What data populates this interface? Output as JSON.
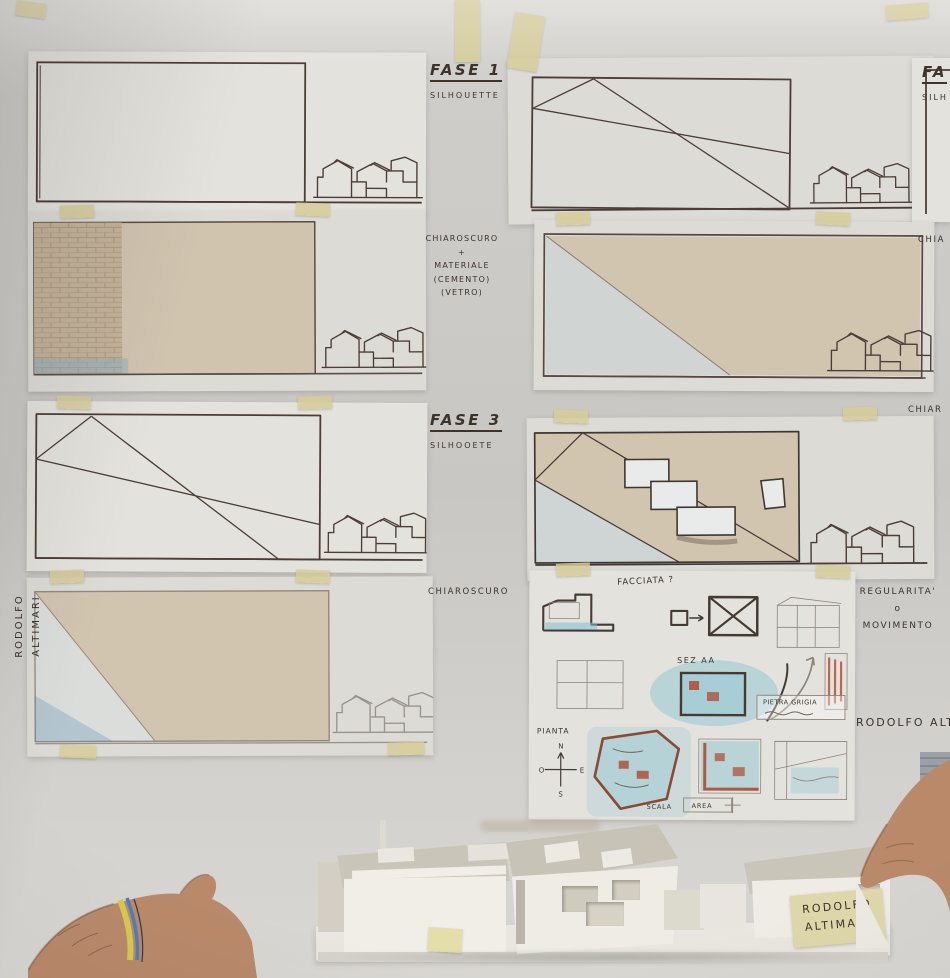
{
  "scene": {
    "description": "Architecture studio pin-up wall: phased facade studies on tracing paper taped above a white cardboard massing model held by two people"
  },
  "colors": {
    "tape": "#d5cc96",
    "wall": "#cbc9c5",
    "paper": "#e4e2dd",
    "render_beige": "#d1c5b0",
    "pencil_cyan": "#7ec0cf",
    "pencil_red": "#b04a30",
    "ink": "#4a3e37",
    "skin": "#b9896a",
    "model_white": "#efede6"
  },
  "labels": {
    "fase1": {
      "title": "FASE 1",
      "subtitle": "SILHOUETTE"
    },
    "fase2_cut": {
      "title": "FA",
      "subtitle": "SILH"
    },
    "materiale": {
      "line1": "CHIAROSCURO",
      "line2": "+",
      "line3": "MATERIALE",
      "line4": "(CEMENTO)",
      "line5": "(VETRO)"
    },
    "chia_cut": "CHIA",
    "fase3": {
      "title": "FASE 3",
      "subtitle": "SILHOOETE"
    },
    "chiar_cut": "CHIAR",
    "chiaroscuro": "CHIAROSCURO",
    "regularita": {
      "line1": "REGULARITA'",
      "line2": "o",
      "line3": "MOVIMENTO"
    },
    "author_vertical": {
      "line1": "RODOLFO",
      "line2": "ALTIMARI"
    },
    "author_right_cut": "RODOLFO ALTI",
    "model_tag": {
      "line1": "RODOLFO",
      "line2": "ALTIMARI"
    }
  },
  "sketch_sheet": {
    "facciata": "FACCIATA ?",
    "sez": "SEZ AA",
    "pianta": "PIANTA",
    "pietra": "PIETRA GRIGIA",
    "scala": "SCALA",
    "area": "AREA",
    "compass": {
      "n": "N",
      "s": "S",
      "e": "E",
      "o": "O"
    }
  }
}
